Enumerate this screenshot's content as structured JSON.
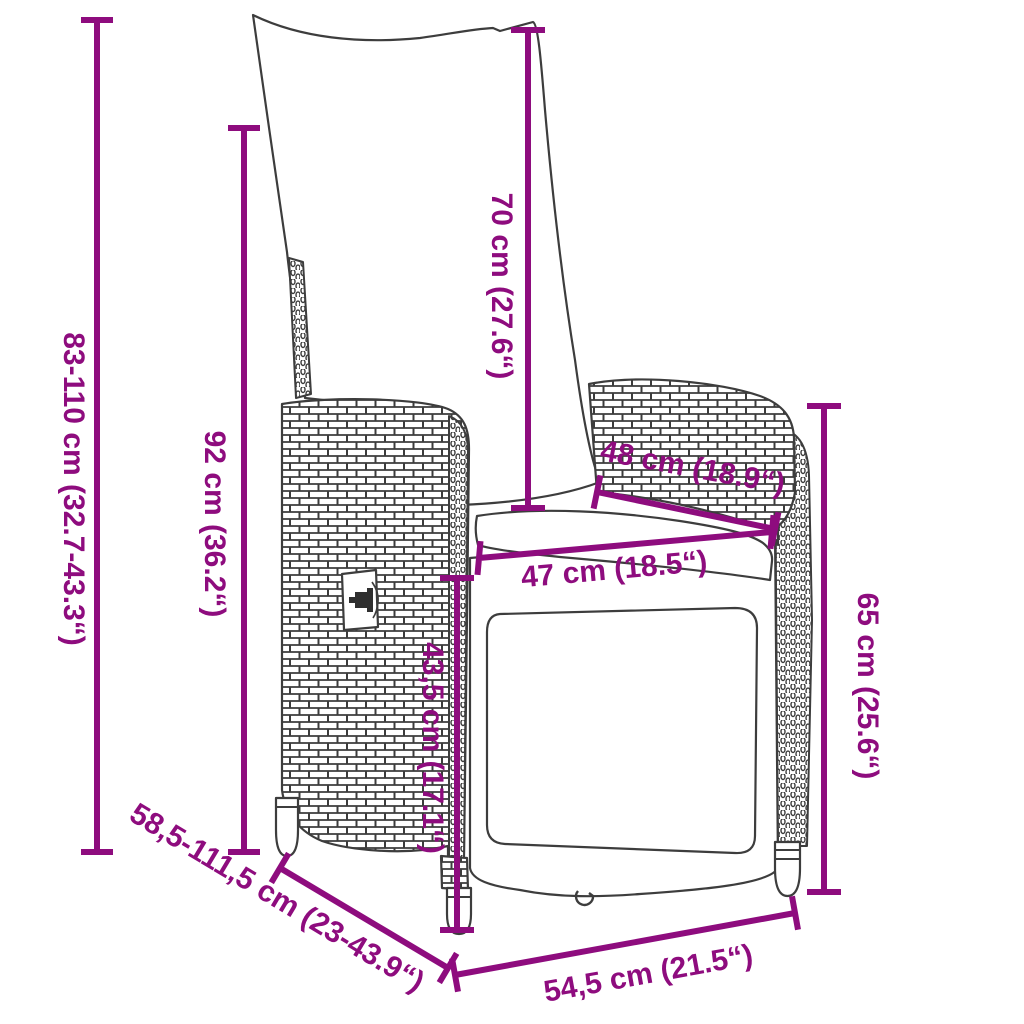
{
  "diagram": {
    "subject": "reclining poly rattan garden chair with cushions",
    "type": "product-dimension-diagram"
  },
  "style": {
    "dimension_color": "#8e0c7e",
    "outline_color": "#3d3d3d",
    "background": "#ffffff"
  },
  "dimensions": {
    "total_height": "83-110 cm (32.7-43.3“)",
    "backrest_height": "92 cm (36.2“)",
    "back_cushion_height": "70 cm (27.6“)",
    "seat_depth": "48 cm (18.9“)",
    "seat_width": "47 cm (18.5“)",
    "seat_height": "43,5 cm (17.1“)",
    "armrest_height": "65 cm (25.6“)",
    "reclined_depth_range": "58,5-111,5 cm (23-43.9“)",
    "base_width": "54,5 cm (21.5“)"
  }
}
